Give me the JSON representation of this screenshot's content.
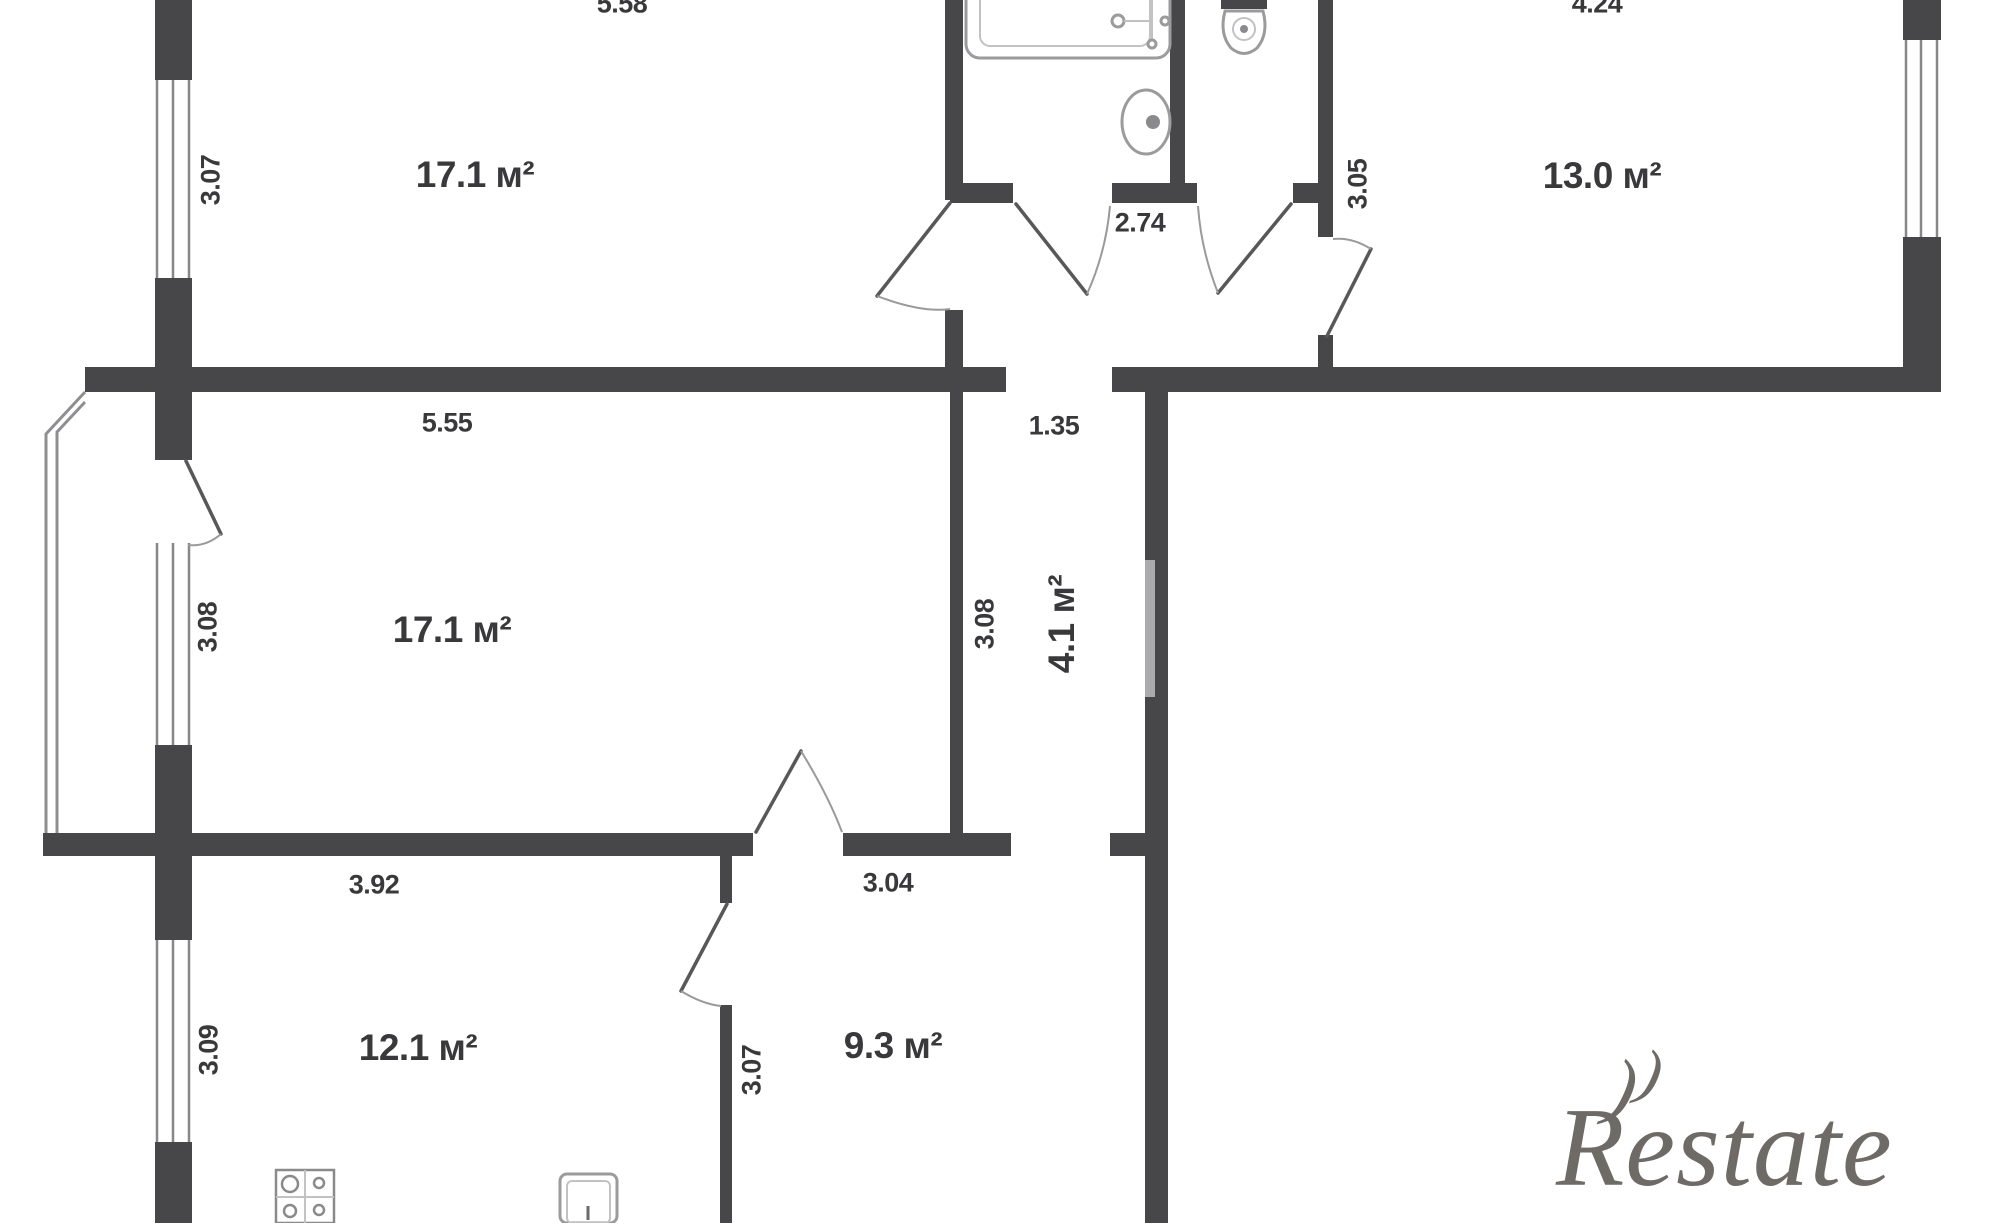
{
  "watermark": {
    "text": "Restate"
  },
  "colors": {
    "wall": "#47474a",
    "line": "#8f8f91",
    "text": "#39393b",
    "watermark": "#6e6a66"
  },
  "units": "м²",
  "rooms": [
    {
      "id": "living-top",
      "area": "17.1 м²"
    },
    {
      "id": "bedroom-right",
      "area": "13.0 м²"
    },
    {
      "id": "living-middle",
      "area": "17.1 м²"
    },
    {
      "id": "corridor",
      "area": "4.1 м²"
    },
    {
      "id": "kitchen",
      "area": "12.1 м²"
    },
    {
      "id": "room-bottom",
      "area": "9.3 м²"
    }
  ],
  "labels": [
    {
      "name": "dim-top-room-width",
      "text": "5.58",
      "x": 622,
      "y": 4,
      "rot": 0,
      "kind": "dim"
    },
    {
      "name": "room-label-living-top",
      "text": "17.1 м²",
      "x": 475,
      "y": 175,
      "rot": 0,
      "kind": "room"
    },
    {
      "name": "dim-top-room-height",
      "text": "3.07",
      "x": 211,
      "y": 180,
      "rot": -90,
      "kind": "dim"
    },
    {
      "name": "dim-bathroom-width",
      "text": "2.74",
      "x": 1140,
      "y": 223,
      "rot": 0,
      "kind": "dim"
    },
    {
      "name": "dim-bedroom-right-height",
      "text": "3.05",
      "x": 1358,
      "y": 184,
      "rot": -90,
      "kind": "dim"
    },
    {
      "name": "dim-bedroom-right-width",
      "text": "4.24",
      "x": 1597,
      "y": 4,
      "rot": 0,
      "kind": "dim"
    },
    {
      "name": "room-label-bedroom-right",
      "text": "13.0 м²",
      "x": 1602,
      "y": 176,
      "rot": 0,
      "kind": "room"
    },
    {
      "name": "dim-living-mid-width",
      "text": "5.55",
      "x": 447,
      "y": 423,
      "rot": 0,
      "kind": "dim"
    },
    {
      "name": "dim-corridor-width",
      "text": "1.35",
      "x": 1054,
      "y": 426,
      "rot": 0,
      "kind": "dim"
    },
    {
      "name": "room-label-living-mid",
      "text": "17.1 м²",
      "x": 452,
      "y": 630,
      "rot": 0,
      "kind": "room"
    },
    {
      "name": "dim-living-mid-height",
      "text": "3.08",
      "x": 208,
      "y": 627,
      "rot": -90,
      "kind": "dim"
    },
    {
      "name": "dim-corridor-height",
      "text": "3.08",
      "x": 985,
      "y": 624,
      "rot": -90,
      "kind": "dim"
    },
    {
      "name": "room-label-corridor",
      "text": "4.1 м²",
      "x": 1062,
      "y": 624,
      "rot": -90,
      "kind": "room"
    },
    {
      "name": "dim-kitchen-width",
      "text": "3.92",
      "x": 374,
      "y": 885,
      "rot": 0,
      "kind": "dim"
    },
    {
      "name": "dim-room-bottom-width",
      "text": "3.04",
      "x": 888,
      "y": 883,
      "rot": 0,
      "kind": "dim"
    },
    {
      "name": "dim-kitchen-height",
      "text": "3.09",
      "x": 209,
      "y": 1050,
      "rot": -90,
      "kind": "dim"
    },
    {
      "name": "room-label-kitchen",
      "text": "12.1 м²",
      "x": 418,
      "y": 1048,
      "rot": 0,
      "kind": "room"
    },
    {
      "name": "dim-room-bottom-height",
      "text": "3.07",
      "x": 752,
      "y": 1070,
      "rot": -90,
      "kind": "dim"
    },
    {
      "name": "room-label-bottom",
      "text": "9.3 м²",
      "x": 893,
      "y": 1046,
      "rot": 0,
      "kind": "room"
    }
  ]
}
